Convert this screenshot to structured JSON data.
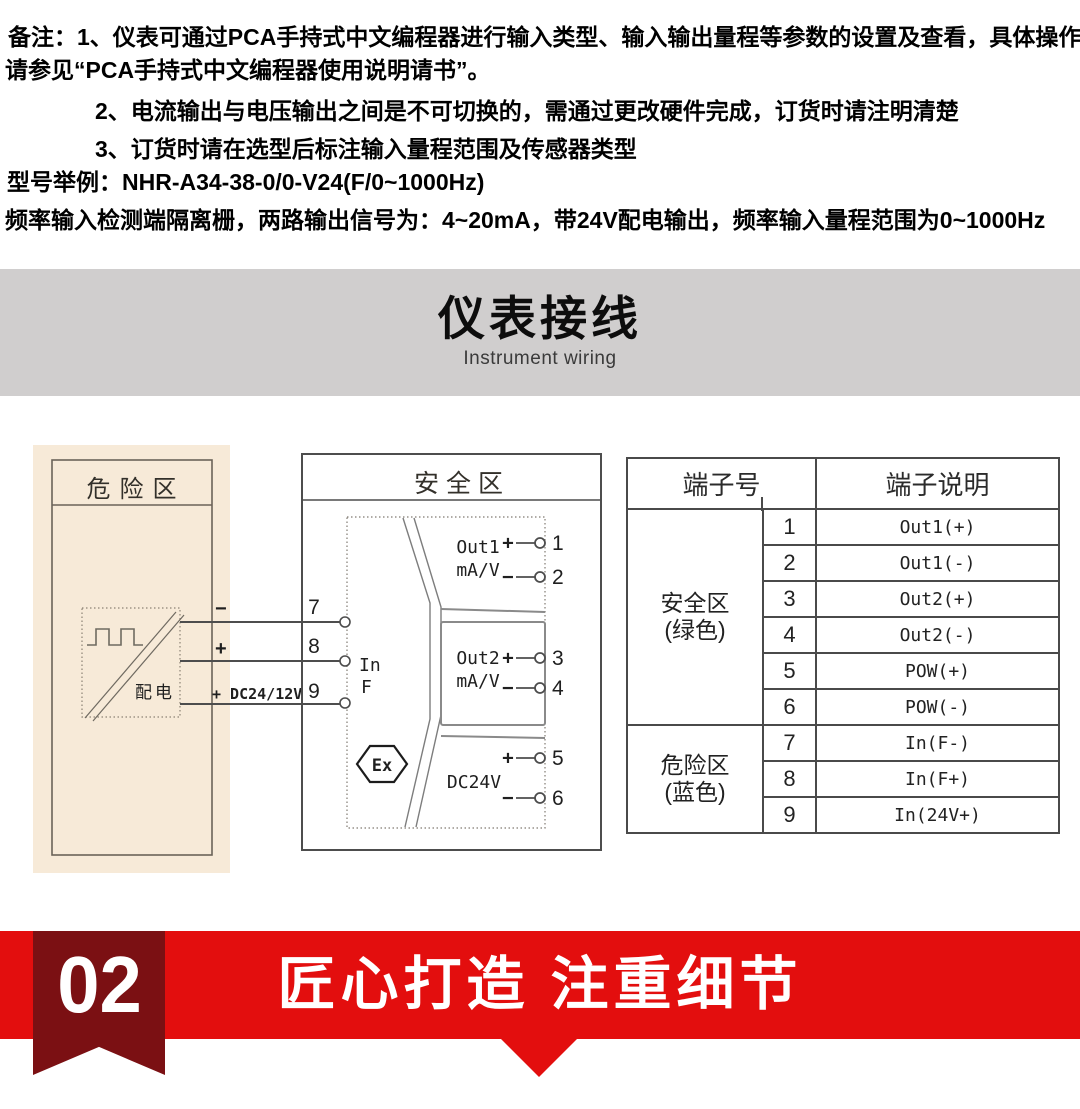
{
  "notes": {
    "line1": "备注：1、仪表可通过PCA手持式中文编程器进行输入类型、输入输出量程等参数的设置及查看，具体操作",
    "line2": "请参见“PCA手持式中文编程器使用说明请书”。",
    "line3": "2、电流输出与电压输出之间是不可切换的，需通过更改硬件完成，订货时请注明清楚",
    "line4": "3、订货时请在选型后标注输入量程范围及传感器类型",
    "model_example": "型号举例：NHR-A34-38-0/0-V24(F/0~1000Hz)",
    "description": "频率输入检测端隔离栅，两路输出信号为：4~20mA，带24V配电输出，频率输入量程范围为0~1000Hz"
  },
  "section_banner": {
    "title": "仪表接线",
    "subtitle": "Instrument wiring"
  },
  "diagram": {
    "danger_zone_label": "危险区",
    "safe_zone_label": "安全区",
    "power_dist_label": "配电",
    "wire_labels": [
      "−",
      "+",
      "+ DC24/12V"
    ],
    "left_terminals": [
      "7",
      "8",
      "9"
    ],
    "input_label_line1": "In",
    "input_label_line2": "F",
    "out1_line1": "Out1",
    "out1_line2": "mA/V",
    "out2_line1": "Out2",
    "out2_line2": "mA/V",
    "dc_label": "DC24V",
    "ex_label": "Ex",
    "right_terminals": [
      {
        "sign": "+",
        "num": "1"
      },
      {
        "sign": "−",
        "num": "2"
      },
      {
        "sign": "+",
        "num": "3"
      },
      {
        "sign": "−",
        "num": "4"
      },
      {
        "sign": "+",
        "num": "5"
      },
      {
        "sign": "−",
        "num": "6"
      }
    ]
  },
  "terminal_table": {
    "header_col1": "端子号",
    "header_col2": "端子说明",
    "groups": [
      {
        "label_line1": "安全区",
        "label_line2": "(绿色)",
        "rows": [
          [
            "1",
            "Out1(+)"
          ],
          [
            "2",
            "Out1(-)"
          ],
          [
            "3",
            "Out2(+)"
          ],
          [
            "4",
            "Out2(-)"
          ],
          [
            "5",
            "POW(+)"
          ],
          [
            "6",
            "POW(-)"
          ]
        ]
      },
      {
        "label_line1": "危险区",
        "label_line2": "(蓝色)",
        "rows": [
          [
            "7",
            "In(F-)"
          ],
          [
            "8",
            "In(F+)"
          ],
          [
            "9",
            "In(24V+)"
          ]
        ]
      }
    ]
  },
  "footer_banner": {
    "badge": "02",
    "title": "匠心打造 注重细节"
  },
  "colors": {
    "band_red": "#e30e0e",
    "ribbon_maroon": "#7b1013",
    "banner_gray": "#d0cece",
    "danger_beige": "#f7ead8",
    "line_dark": "#4a4a4a"
  }
}
